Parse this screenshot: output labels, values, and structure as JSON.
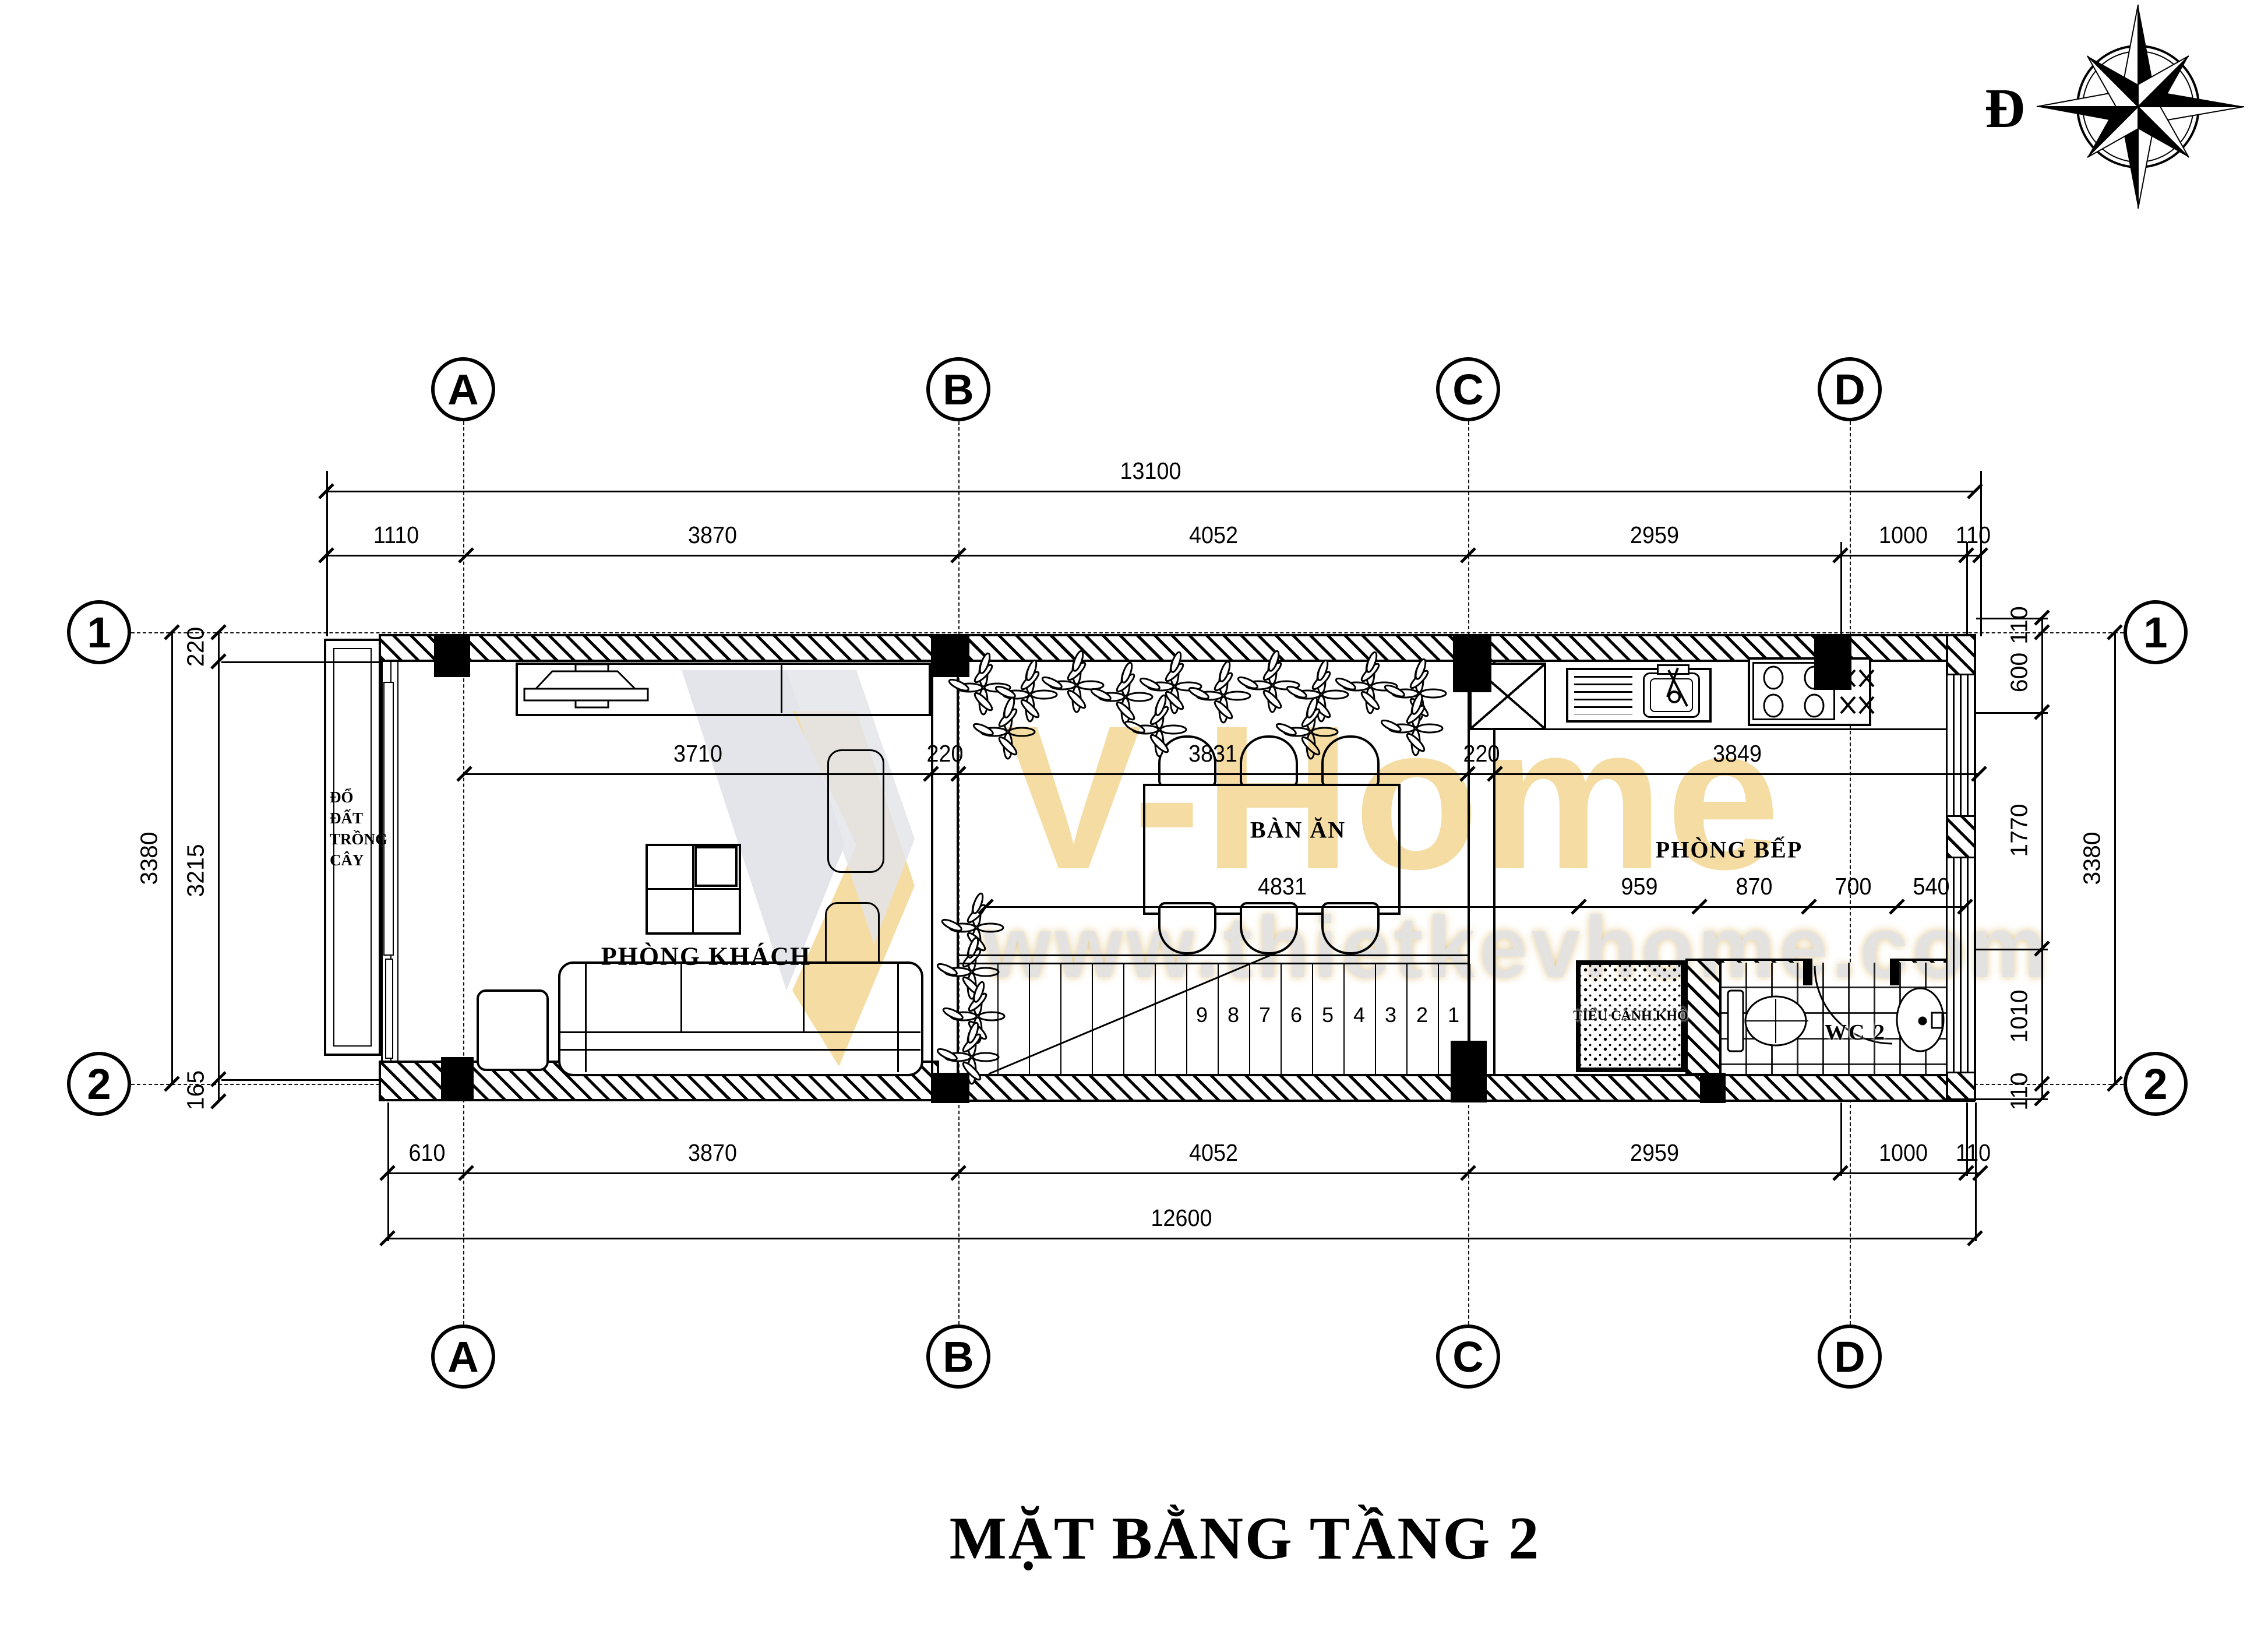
{
  "page": {
    "title_block": "MẶT BẰNG TẦNG 2"
  },
  "compass": {
    "label": "Đ"
  },
  "watermark": {
    "brand": "V-Home",
    "url": "www.thietkevhome.com"
  },
  "colors": {
    "watermark_orange": "#F2CE7F",
    "watermark_grey": "#D8DBE2",
    "paper": "#FFFFFF",
    "ink": "#000000"
  },
  "grid": {
    "cols": [
      "A",
      "B",
      "C",
      "D"
    ],
    "rows": [
      "1",
      "2"
    ]
  },
  "rooms": {
    "living": "PHÒNG KHÁCH",
    "dining_table": "BÀN ĂN",
    "kitchen": "PHÒNG BẾP",
    "wc": "WC 2",
    "dry_garden": "TIỂU CẢNH KHÔ",
    "planter": [
      "ĐỔ",
      "ĐẤT",
      "TRỒNG",
      "CÂY"
    ]
  },
  "stairs": {
    "steps": [
      "9",
      "8",
      "7",
      "6",
      "5",
      "4",
      "3",
      "2",
      "1"
    ]
  },
  "dimensions": {
    "top_total": "13100",
    "top_chain": [
      "1110",
      "3870",
      "4052",
      "2959",
      "1000",
      "110"
    ],
    "bottom_chain": [
      "610",
      "3870",
      "4052",
      "2959",
      "1000",
      "110"
    ],
    "bottom_total": "12600",
    "left_outer": "3380",
    "left_chain": [
      "220",
      "3215",
      "165"
    ],
    "right_chain": [
      "110",
      "600",
      "1770",
      "1010",
      "110"
    ],
    "right_outer": "3380",
    "interior_top_chain": [
      "3710",
      "220",
      "3831",
      "220",
      "3849"
    ],
    "interior_mid_chain": [
      "4831",
      "959",
      "870",
      "700",
      "540"
    ]
  }
}
